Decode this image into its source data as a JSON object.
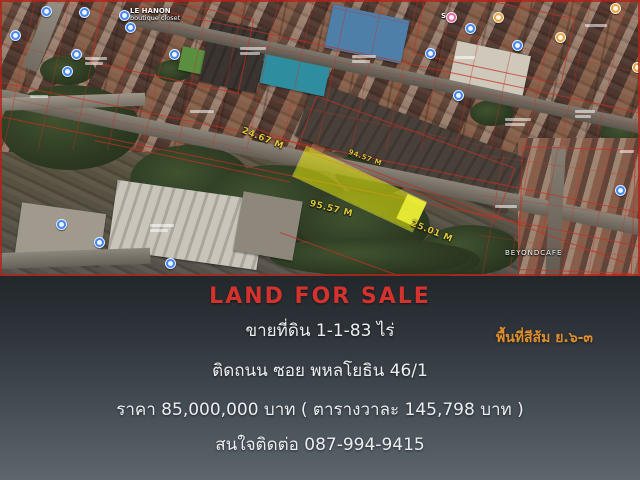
{
  "map": {
    "plot_measurements": {
      "left_edge": "24.67 M",
      "top_edge": "94.57 M",
      "bottom_edge": "95.57 M",
      "right_edge": "25.01 M"
    },
    "labels": {
      "boutique_line1": "LE HANON",
      "boutique_line2": "boutique closet",
      "st_shop": "S.T",
      "cafe": "BEYONDCAFE"
    },
    "plot_fill_color": "#e6eb0a",
    "measurement_text_color": "#dcc738",
    "parcel_line_color": "#c33023",
    "pin_colors": {
      "store": "#4285f4",
      "food": "#e8a33d",
      "boutique": "#e06a9f"
    }
  },
  "panel": {
    "headline": "LAND FOR SALE",
    "headline_color": "#d4322c",
    "sale_line": "ขายที่ดิน  1-1-83 ไร่",
    "zone_note": "พื้นที่สีส้ม ย.๖-๓",
    "zone_note_color": "#df8e2d",
    "street_line": "ติดถนน ซอย พหลโยธิน 46/1",
    "price_line": "ราคา  85,000,000  บาท ( ตารางวาละ 145,798  บาท )",
    "contact_line": "สนใจติดต่อ 087-994-9415"
  }
}
